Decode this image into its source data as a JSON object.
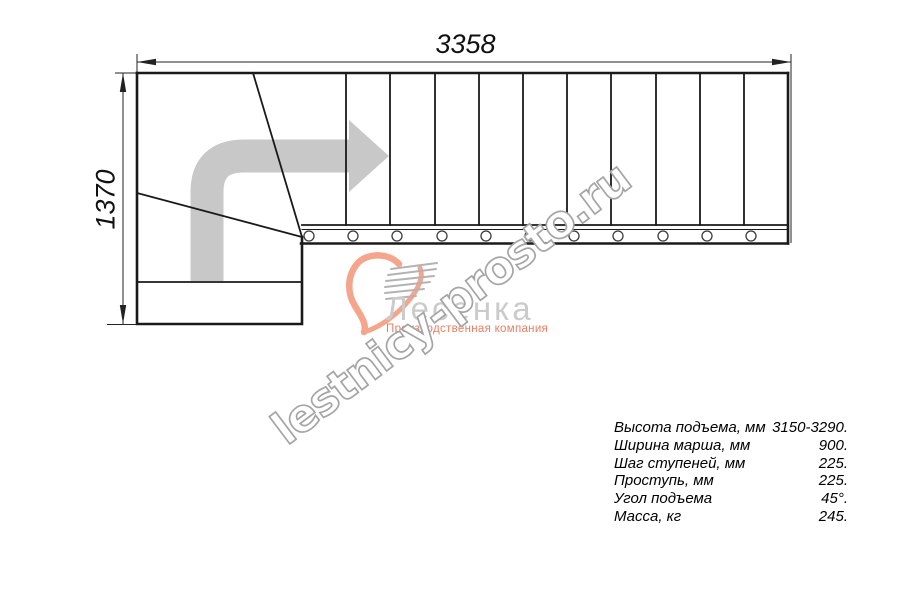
{
  "drawing": {
    "title": "Staircase top-view plan",
    "width_dim": "3358",
    "height_dim": "1370"
  },
  "watermark": {
    "text": "lestnicy-prosto.ru"
  },
  "logo": {
    "name": "Лесенка",
    "tagline": "Производственная компания"
  },
  "specs": {
    "rows": [
      {
        "label": "Высота подъема, мм",
        "value": "3150-3290."
      },
      {
        "label": "Ширина марша, мм",
        "value": "900."
      },
      {
        "label": "Шаг ступеней, мм",
        "value": "225."
      },
      {
        "label": "Проступь, мм",
        "value": "225."
      },
      {
        "label": "Угол подъема",
        "value": "45°."
      },
      {
        "label": "Масса, кг",
        "value": "245."
      }
    ]
  },
  "colors": {
    "line": "#1a1a1a",
    "direction_arrow": "#c8c8c8",
    "watermark_outline": "#a5a5a5",
    "logo_name": "#cbcbcb",
    "logo_salmon": "#f5a58c",
    "tagline_salmon": "#e87f63"
  }
}
